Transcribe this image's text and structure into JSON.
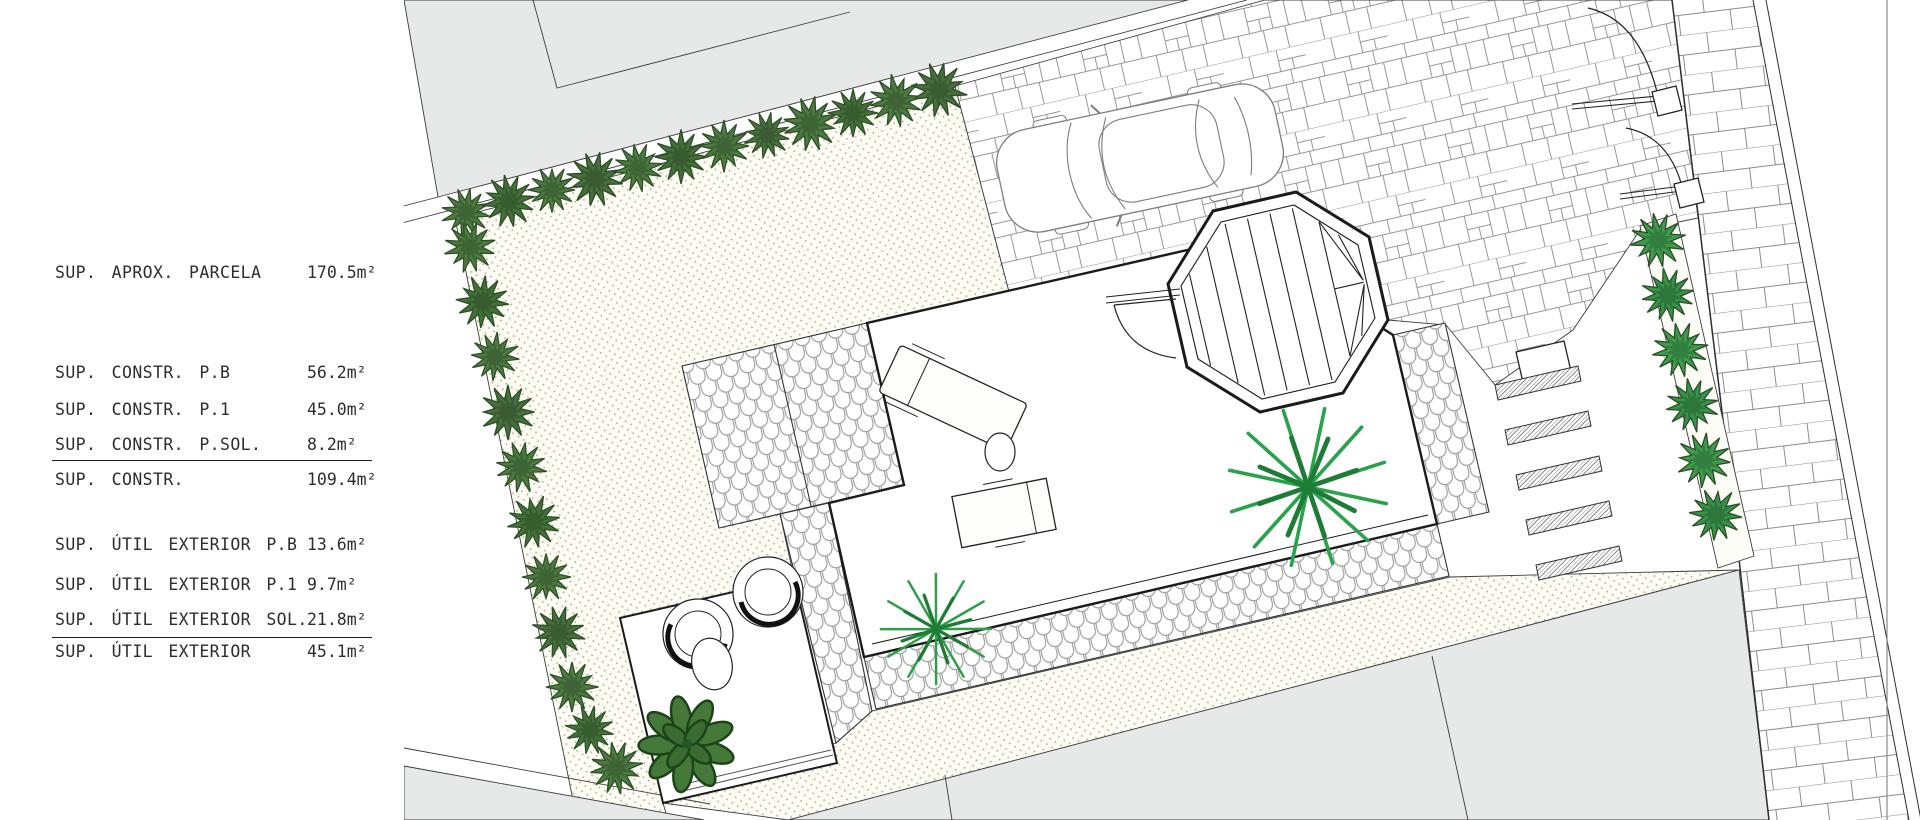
{
  "drawing": {
    "type": "architectural site plan",
    "language": "Spanish"
  },
  "legend": {
    "rows": [
      {
        "label": "SUP. APROX. PARCELA",
        "value": "170.5m²"
      },
      {
        "label": "SUP. CONSTR. P.B",
        "value": "56.2m²"
      },
      {
        "label": "SUP. CONSTR. P.1",
        "value": "45.0m²"
      },
      {
        "label": "SUP. CONSTR. P.SOL.",
        "value": "8.2m²"
      },
      {
        "label": "SUP. CONSTR.",
        "value": "109.4m²"
      },
      {
        "label": "SUP. ÚTIL EXTERIOR P.B",
        "value": "13.6m²"
      },
      {
        "label": "SUP. ÚTIL EXTERIOR P.1",
        "value": "9.7m²"
      },
      {
        "label": "SUP. ÚTIL EXTERIOR SOL.",
        "value": "21.8m²"
      },
      {
        "label": "SUP. ÚTIL EXTERIOR",
        "value": "45.1m²"
      }
    ]
  },
  "plan": {
    "features": [
      "neighbor parcels",
      "sidewalk",
      "gravel garden",
      "hedge rows",
      "flagstone driveway",
      "parked car",
      "terrace",
      "octagonal stair",
      "cobblestone paths",
      "outdoor furniture",
      "papasan chairs",
      "palm plants",
      "leafy tree",
      "brick sidewalk",
      "gate door swings",
      "exterior steps"
    ],
    "colors": {
      "parcel_gray": "#e7e9e9",
      "stipple_dot": "#a9a981",
      "hedge_dark_green": "#4c7a41",
      "shrub_medium_green": "#3f9b4d",
      "plant_bright_green": "#2aa24c",
      "line_black": "#1b1b1b",
      "paving_line_gray": "#979797"
    }
  }
}
